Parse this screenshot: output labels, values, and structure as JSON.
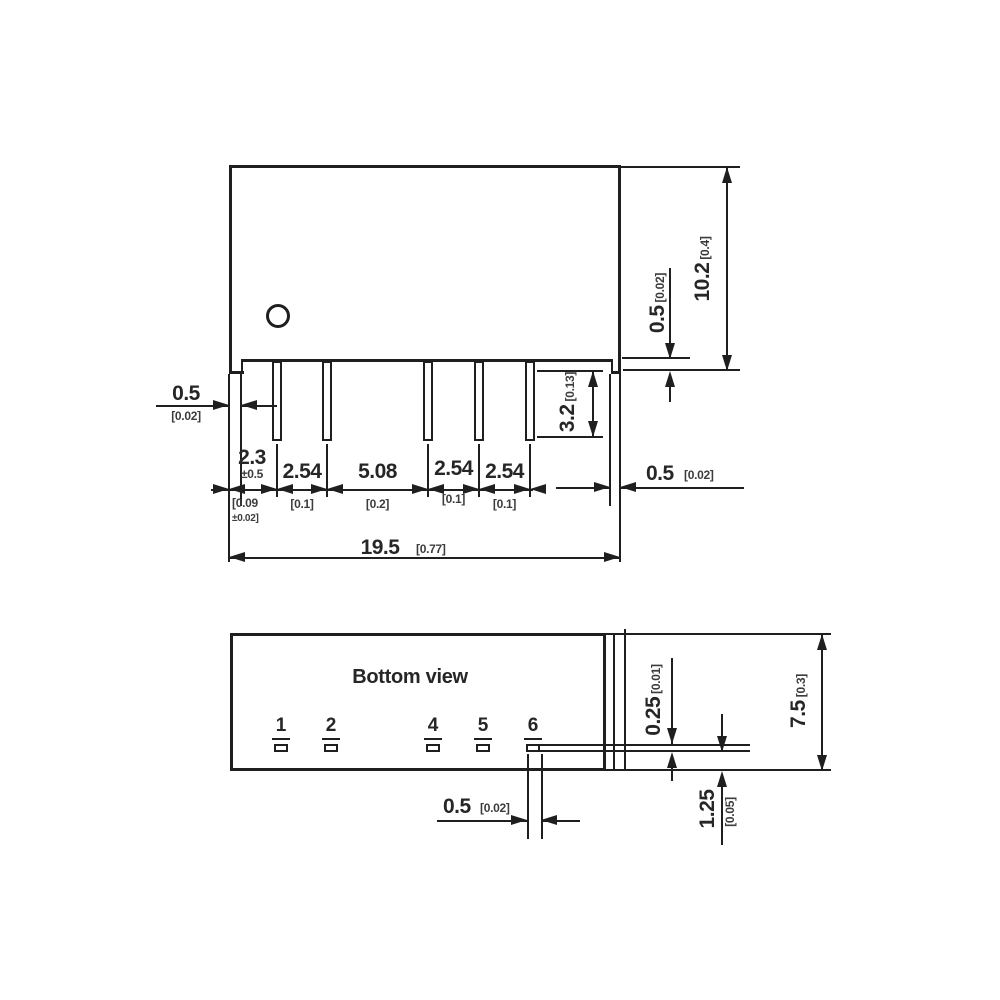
{
  "side_view": {
    "dims": {
      "edge_left": {
        "v": "0.5",
        "a": "[0.02]"
      },
      "pin1": {
        "v": "2.3",
        "tol": "±0.5",
        "a1": "[0.09",
        "a2": "±0.02]"
      },
      "p12": {
        "v": "2.54",
        "a": "[0.1]"
      },
      "p24": {
        "v": "5.08",
        "a": "[0.2]"
      },
      "p45": {
        "v": "2.54",
        "a": "[0.1]"
      },
      "p56": {
        "v": "2.54",
        "a": "[0.1]"
      },
      "length": {
        "v": "19.5",
        "a": "[0.77]"
      },
      "edge_right": {
        "v": "0.5",
        "a": "[0.02]"
      },
      "standoff": {
        "v": "0.5",
        "a": "[0.02]"
      },
      "height": {
        "v": "10.2",
        "a": "[0.4]"
      },
      "pin_length": {
        "v": "3.2",
        "a": "[0.13]"
      }
    }
  },
  "bottom_view": {
    "title": "Bottom view",
    "pins": [
      "1",
      "2",
      "4",
      "5",
      "6"
    ],
    "dims": {
      "pad_thickness": {
        "v": "0.25",
        "a": "[0.01]"
      },
      "depth": {
        "v": "7.5",
        "a": "[0.3]"
      },
      "row_offset": {
        "v": "1.25",
        "a": "[0.05]"
      },
      "pad_width": {
        "v": "0.5",
        "a": "[0.02]"
      }
    }
  },
  "colors": {
    "line": "#1f1f1f",
    "text": "#262626",
    "background": "#ffffff"
  }
}
